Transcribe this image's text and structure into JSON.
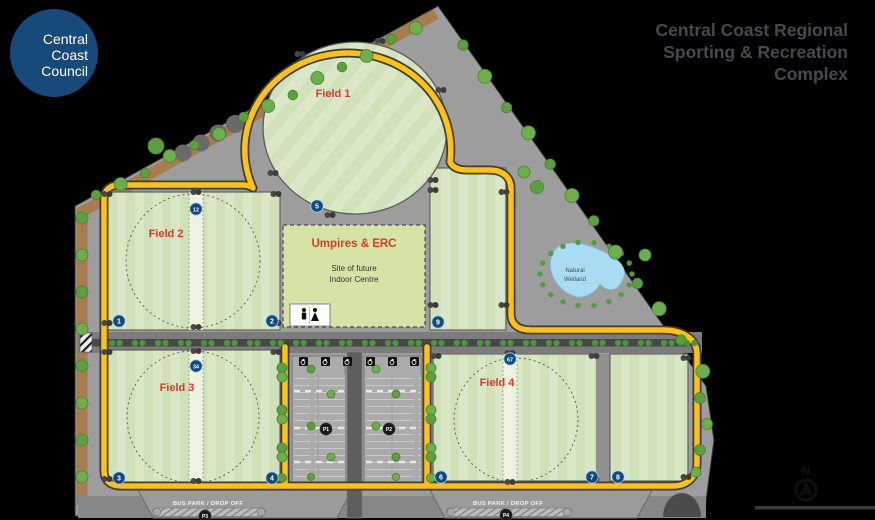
{
  "header": {
    "logo": {
      "lines": [
        "Central",
        "Coast",
        "Council"
      ],
      "bg_color": "#17497B"
    },
    "title": {
      "lines": [
        "Central Coast Regional",
        "Sporting & Recreation",
        "Complex"
      ],
      "color": "#47484D"
    }
  },
  "map": {
    "fields": [
      {
        "name": "Field 1"
      },
      {
        "name": "Field 2"
      },
      {
        "name": "Field 3"
      },
      {
        "name": "Field 4"
      }
    ],
    "building": {
      "title": "Umpires & ERC",
      "lines": [
        "Site of future",
        "Indoor Centre"
      ]
    },
    "wetland": {
      "lines": [
        "Natural",
        "Wetland"
      ]
    },
    "bus_park_label": "BUS PARK / DROP OFF",
    "north_label": "N",
    "field_markers": [
      {
        "label": "1",
        "x": 119,
        "y": 321
      },
      {
        "label": "2",
        "x": 272,
        "y": 321
      },
      {
        "label": "12",
        "x": 196,
        "y": 209
      },
      {
        "label": "3",
        "x": 119,
        "y": 478
      },
      {
        "label": "4",
        "x": 272,
        "y": 478
      },
      {
        "label": "34",
        "x": 196,
        "y": 366
      },
      {
        "label": "5",
        "x": 317,
        "y": 206
      },
      {
        "label": "9",
        "x": 438,
        "y": 322
      },
      {
        "label": "6",
        "x": 441,
        "y": 477
      },
      {
        "label": "7",
        "x": 592,
        "y": 477
      },
      {
        "label": "8",
        "x": 618,
        "y": 477
      },
      {
        "label": "67",
        "x": 510,
        "y": 359
      }
    ],
    "parking_markers": [
      {
        "label": "P1",
        "x": 326,
        "y": 429
      },
      {
        "label": "P2",
        "x": 389,
        "y": 429
      },
      {
        "label": "P3",
        "x": 205,
        "y": 516
      },
      {
        "label": "P4",
        "x": 506,
        "y": 515
      }
    ],
    "colors": {
      "road_yellow": "#FFC20E",
      "field_green": "#D9E7C6",
      "marker_blue": "#114A80",
      "label_red": "#E0382E",
      "wetland_blue": "#A9DCF2",
      "edge_brown": "#A87C4F",
      "site_gray": "#9D9D9D"
    }
  }
}
